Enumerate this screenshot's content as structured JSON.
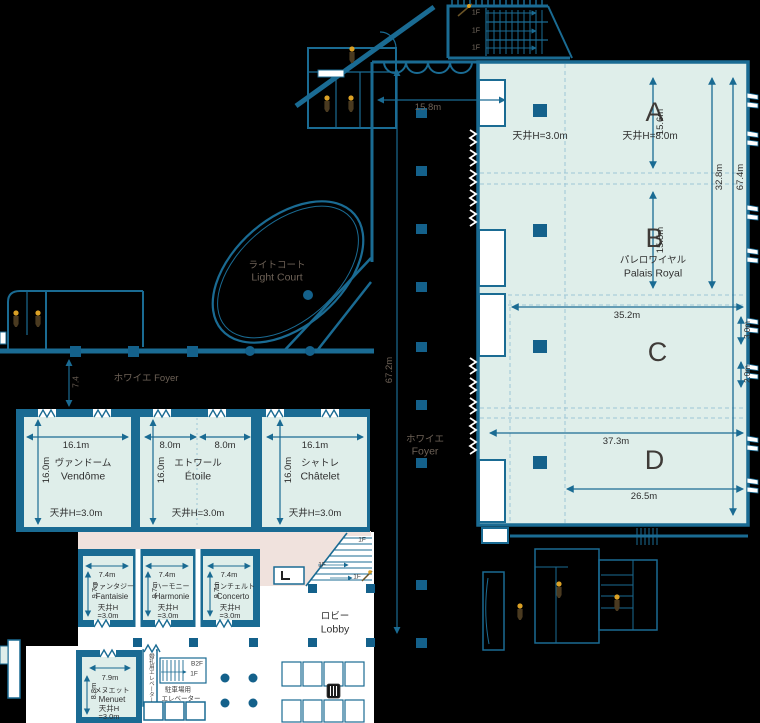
{
  "palette": {
    "background": "#000000",
    "wall": "#1a6b93",
    "room_fill": "#dfeeea",
    "pillar": "#14618b",
    "concourse_pink": "#f0e2dd",
    "paper_white": "#ffffff",
    "label_on_dark": "#6e6257",
    "label_on_light": "#303030"
  },
  "palais_royal": {
    "sections": [
      "A",
      "B",
      "C",
      "D"
    ],
    "name_ja": "パレロワイヤル",
    "name_en": "Palais Royal",
    "ceiling_side": "天井H=3.0m",
    "ceiling_main": "天井H=8.0m",
    "dim_a_depth": "15.6m",
    "dim_ab_depth": "32.8m",
    "dim_full_depth": "67.4m",
    "dim_b_depth": "15.5m",
    "dim_c_width": "35.2m",
    "dim_side_upper": "3.0m",
    "dim_side_lower": "2.0m",
    "dim_d_width": "37.3m",
    "dim_d_lower_width": "26.5m"
  },
  "corridor_foyer": {
    "name_ja": "ホワイエ",
    "name_en": "Foyer",
    "dim_length": "67.2m",
    "dim_entrance": "15.8m"
  },
  "west_foyer": {
    "label": "ホワイエ Foyer",
    "dim_depth": "7.4"
  },
  "light_court": {
    "name_ja": "ライトコート",
    "name_en": "Light Court"
  },
  "lobby": {
    "name_ja": "ロビー",
    "name_en": "Lobby"
  },
  "banquet_rooms": [
    {
      "name_ja": "ヴァンドーム",
      "name_en": "Vendôme",
      "dim_width": "16.1m",
      "dim_depth": "16.0m",
      "ceiling": "天井H=3.0m"
    },
    {
      "name_ja": "エトワール",
      "name_en": "Étoile",
      "dim_width_left": "8.0m",
      "dim_width_right": "8.0m",
      "dim_depth": "16.0m",
      "ceiling": "天井H=3.0m"
    },
    {
      "name_ja": "シャトレ",
      "name_en": "Châtelet",
      "dim_width": "16.1m",
      "dim_depth": "16.0m",
      "ceiling": "天井H=3.0m"
    }
  ],
  "salon_rooms": [
    {
      "name_ja": "ファンタジー",
      "name_en": "Fantaisie",
      "dim_width": "7.4m",
      "dim_depth": "9.7m",
      "ceiling_line1": "天井H",
      "ceiling_line2": "=3.0m"
    },
    {
      "name_ja": "ハーモニー",
      "name_en": "Harmonie",
      "dim_width": "7.4m",
      "dim_depth": "9.7m",
      "ceiling_line1": "天井H",
      "ceiling_line2": "=3.0m"
    },
    {
      "name_ja": "コンチェルト",
      "name_en": "Concerto",
      "dim_width": "7.4m",
      "dim_depth": "9.7m",
      "ceiling_line1": "天井H",
      "ceiling_line2": "=3.0m"
    }
  ],
  "menuet_room": {
    "name_ja": "メヌエット",
    "name_en": "Menuet",
    "dim_width": "7.9m",
    "dim_depth": "8.8m",
    "ceiling_line1": "天井H",
    "ceiling_line2": "=3.0m"
  },
  "elevators": {
    "wedding": "婚礼用エレベーター",
    "parking_line1": "駐車場用",
    "parking_line2": "エレベーター"
  },
  "levels": {
    "f1": "1F",
    "b2f": "B2F"
  }
}
